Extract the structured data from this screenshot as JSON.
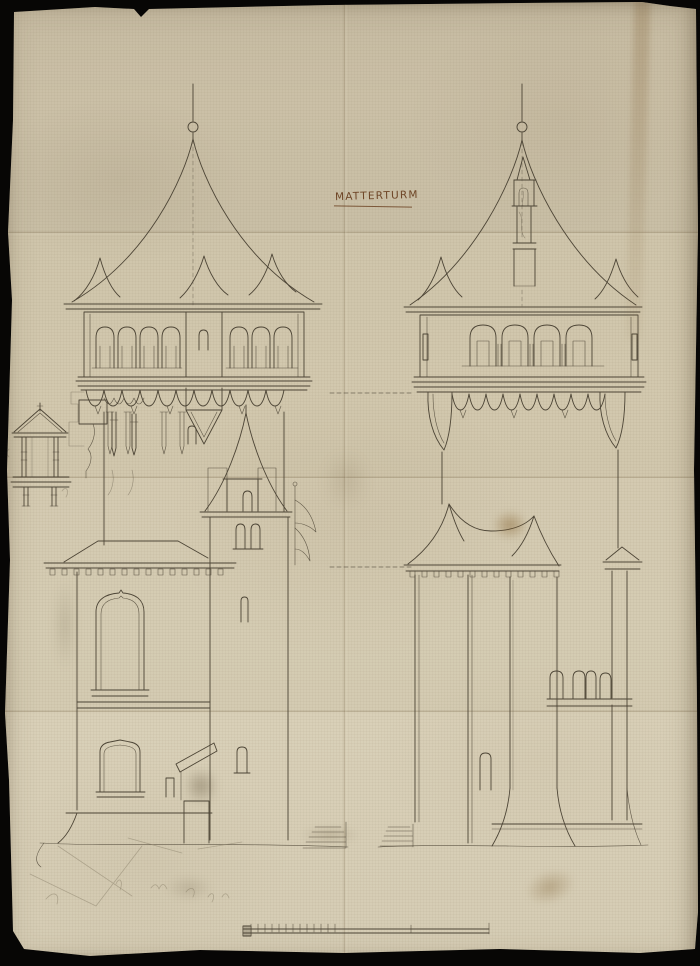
{
  "document": {
    "title": "MATTERTURM"
  },
  "colors": {
    "backdrop": "#070605",
    "paper": "#d1c6ac",
    "ink": "#4d4536",
    "title_ink": "#6e4526",
    "pencil": "#8a7f6a"
  }
}
